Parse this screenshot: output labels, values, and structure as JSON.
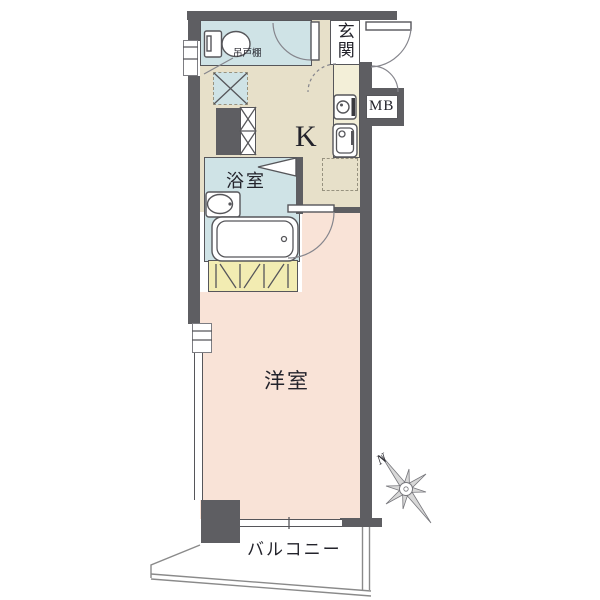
{
  "labels": {
    "entrance": "玄関",
    "kitchen": "K",
    "bathroom": "浴室",
    "western_room": "洋室",
    "balcony": "バルコニー",
    "meter_box": "MB",
    "hanging_cupboard": "吊戸棚",
    "compass_north": "N"
  },
  "colors": {
    "wall": "#5e5e62",
    "room_border": "#56565a",
    "wet_area": "#cfe3e6",
    "kitchen_floor": "#e7e0c9",
    "counter": "#f3efd8",
    "closet": "#f2ecb2",
    "western_room": "#f9e3d7",
    "line": "#8a8a8a",
    "text": "#23232b"
  },
  "fixtures": {
    "toilet": "toilet bowl with tank",
    "bathtub": "bathtub",
    "bath_sink": "washbasin",
    "stove": "single burner stove",
    "kitchen_sink": "kitchen sink",
    "refrigerator_space": "dashed square",
    "washing_machine_space": "crossed square",
    "pipe_space": "crossed shaft boxes",
    "closet": "hatched storage",
    "compass": "eight point north star"
  }
}
